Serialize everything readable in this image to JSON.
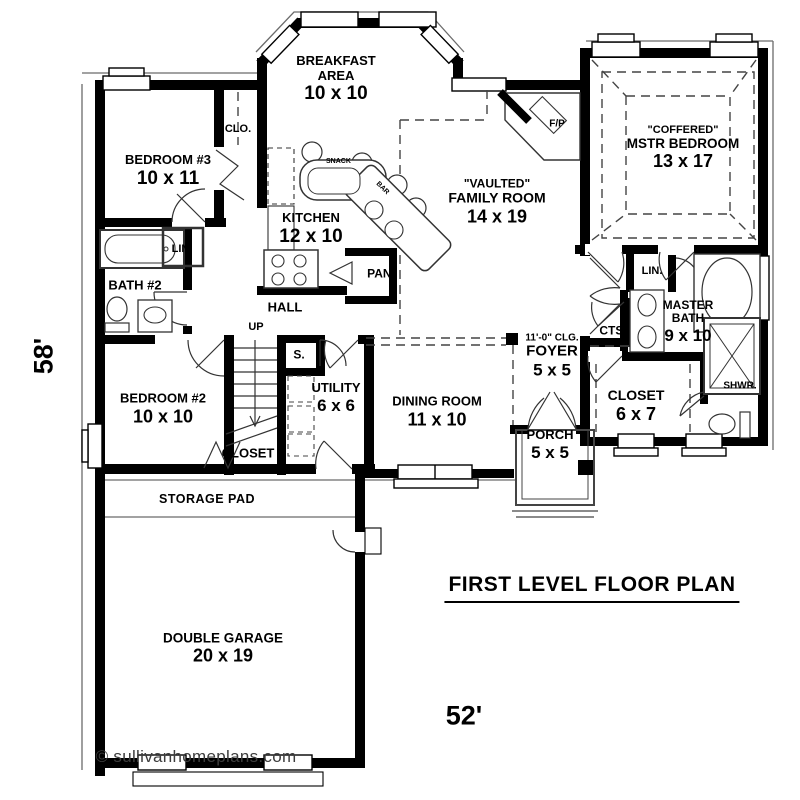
{
  "page": {
    "title": "FIRST LEVEL FLOOR PLAN",
    "width_dim": "52'",
    "height_dim": "58'",
    "watermark": "© sullivanhomeplans.com"
  },
  "colors": {
    "wall": "#000000",
    "background": "#ffffff",
    "detail_line": "#3f3f3f",
    "watermark_text": "#3d3d3d"
  },
  "rooms": {
    "breakfast": {
      "line1": "BREAKFAST",
      "line2": "AREA",
      "dims": "10 x 10"
    },
    "bedroom3": {
      "line1": "BEDROOM #3",
      "dims": "10 x 11"
    },
    "kitchen": {
      "line1": "KITCHEN",
      "dims": "12 x 10"
    },
    "family": {
      "quote": "\"VAULTED\"",
      "line1": "FAMILY ROOM",
      "dims": "14 x 19"
    },
    "master": {
      "quote": "\"COFFERED\"",
      "line1": "MSTR BEDROOM",
      "dims": "13 x 17"
    },
    "bath2": {
      "line1": "BATH #2"
    },
    "hall": {
      "line1": "HALL"
    },
    "bedroom2": {
      "line1": "BEDROOM #2",
      "dims": "10 x 10"
    },
    "utility": {
      "line1": "UTILITY",
      "dims": "6 x 6"
    },
    "dining": {
      "line1": "DINING ROOM",
      "dims": "11 x 10"
    },
    "foyer": {
      "clg": "11'-0\" CLG.",
      "line1": "FOYER",
      "dims": "5 x 5"
    },
    "porch": {
      "line1": "PORCH",
      "dims": "5 x 5"
    },
    "master_bath": {
      "line1": "MASTER",
      "line2": "BATH",
      "dims": "9 x 10"
    },
    "master_closet": {
      "line1": "CLOSET",
      "dims": "6 x 7"
    },
    "closet2": {
      "line1": "CLOSET"
    },
    "storage": {
      "line1": "STORAGE PAD"
    },
    "garage": {
      "line1": "DOUBLE GARAGE",
      "dims": "20 x 19"
    }
  },
  "small_labels": {
    "clo": "CLO.",
    "lin_bath2": "LIN.",
    "lin_master": "LIN.",
    "pan": "PAN.",
    "up": "UP",
    "stair_closet": "S.",
    "cts": "CTS.",
    "shwr": "SHWR.",
    "fp": "F/P"
  },
  "island": {
    "word1": "SNACK",
    "word2": "BAR"
  }
}
